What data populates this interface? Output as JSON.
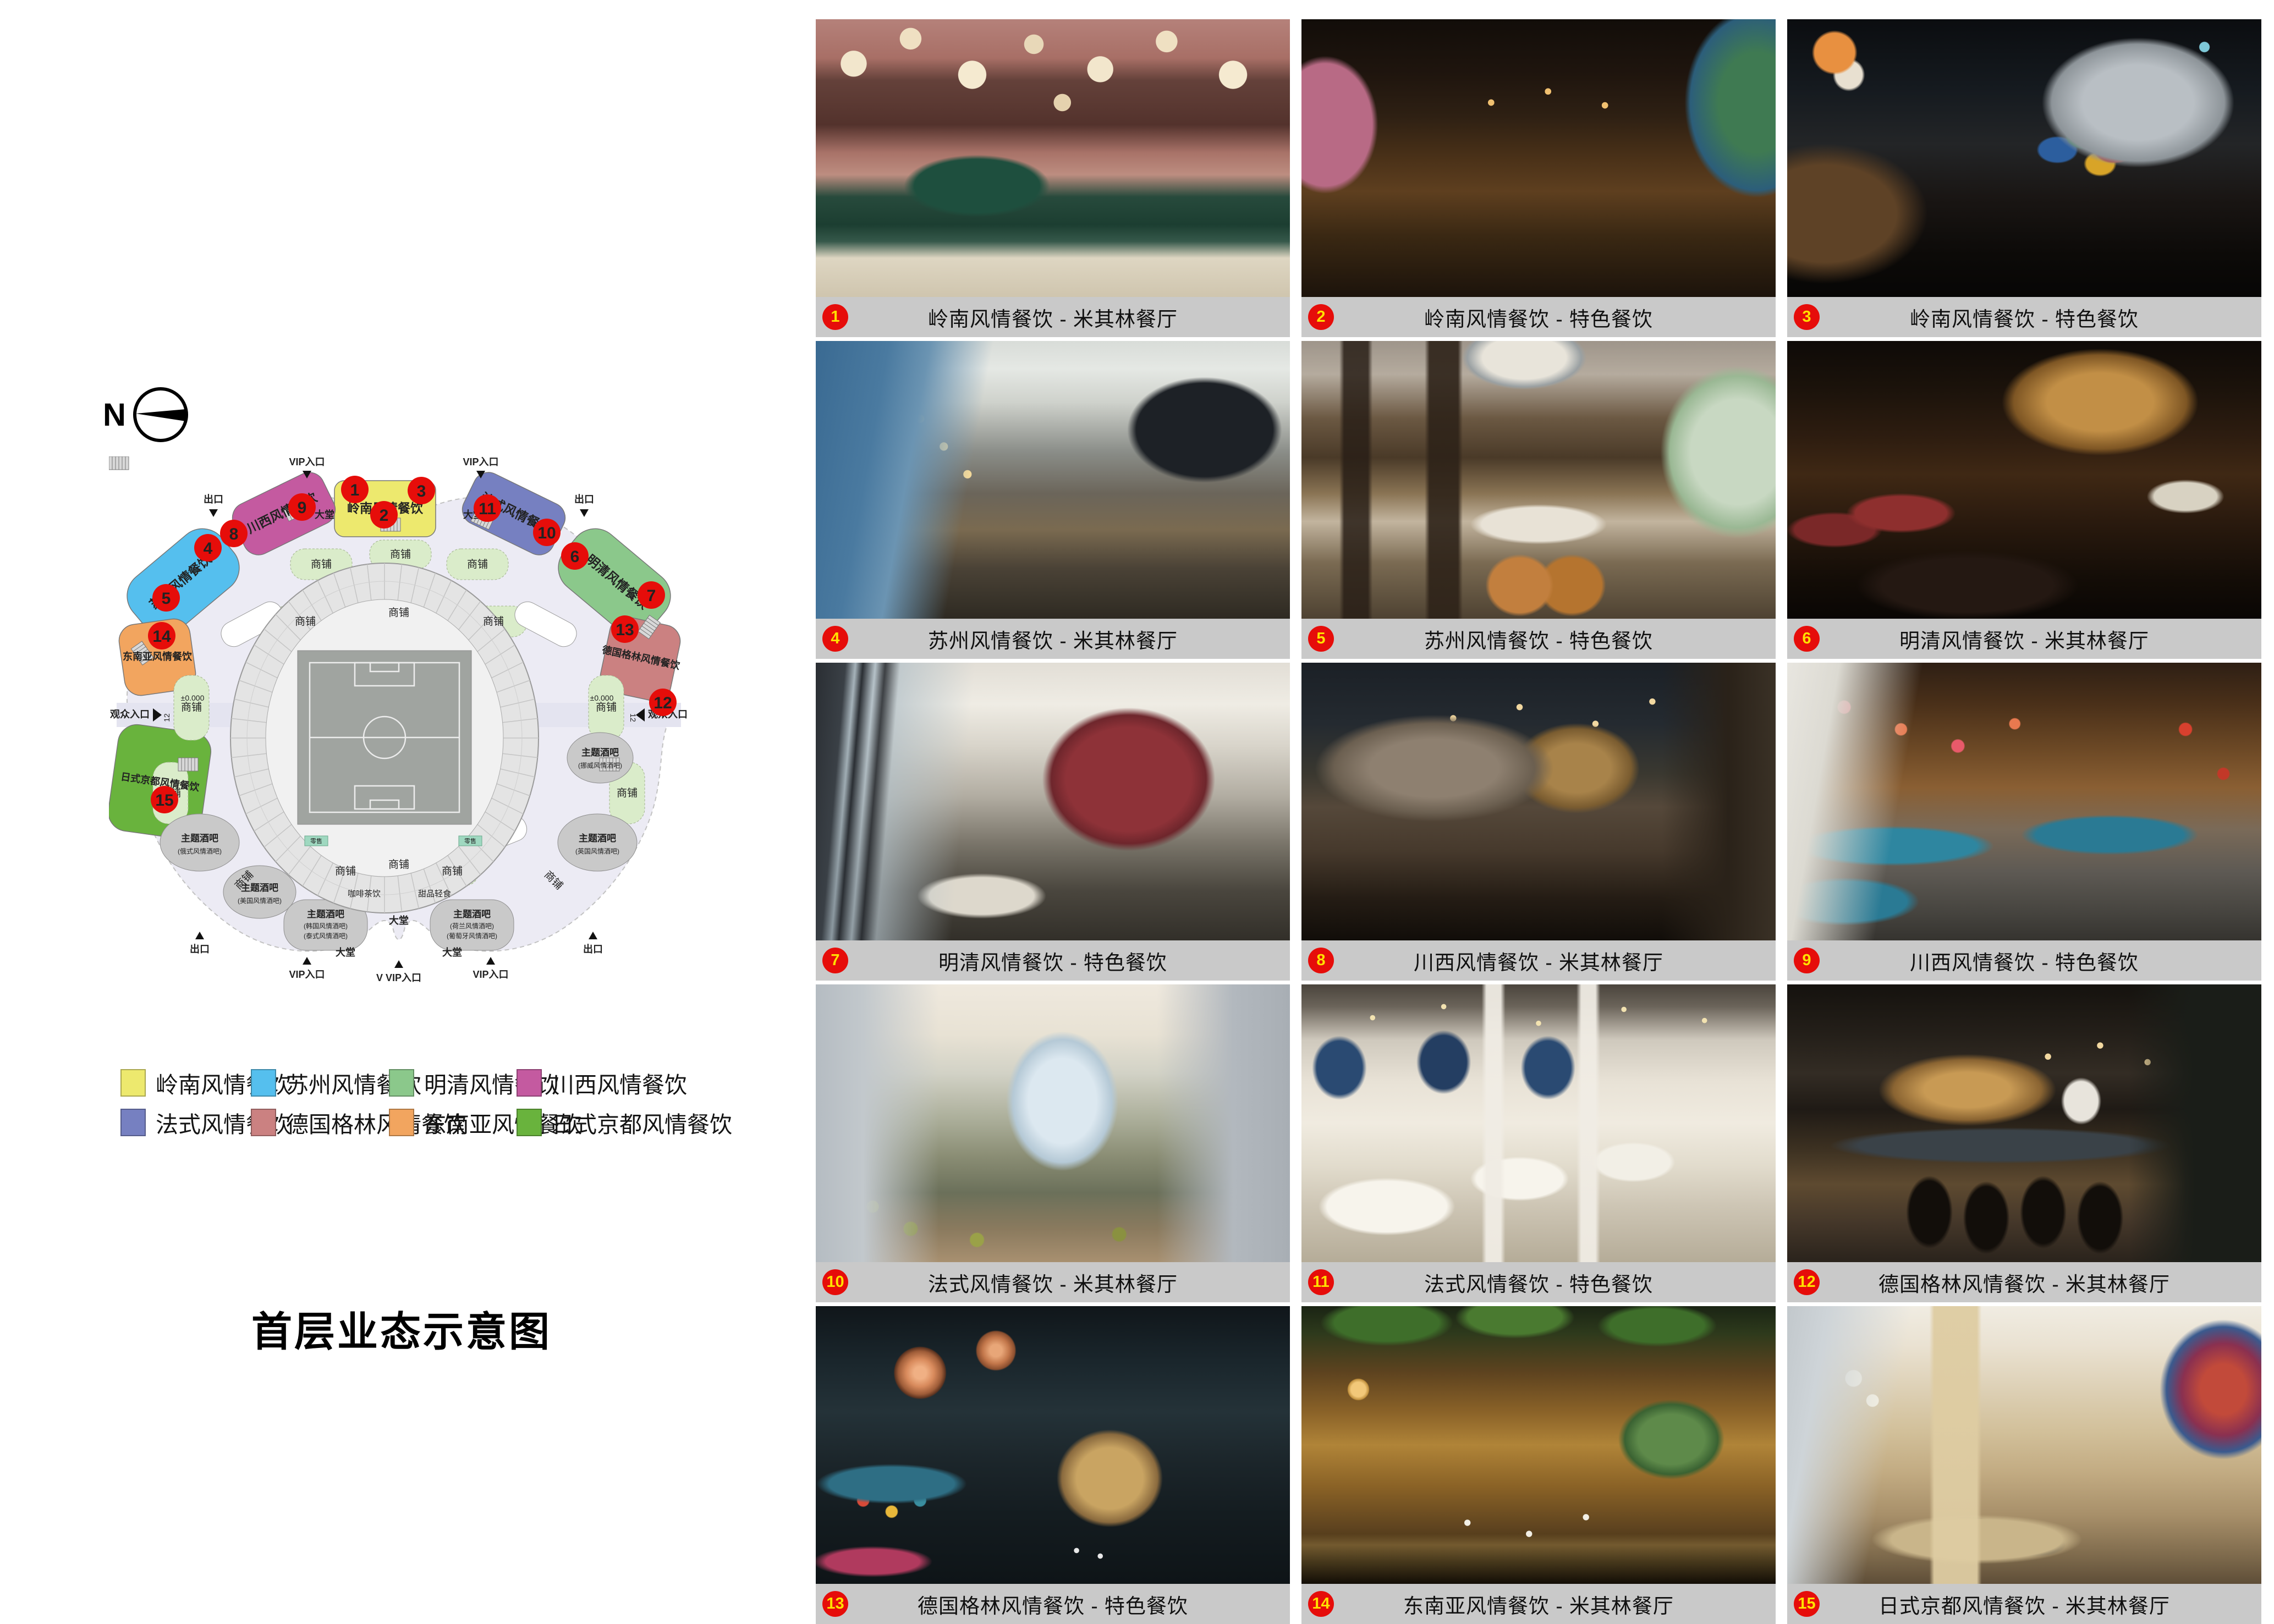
{
  "page": {
    "title": "首层业态示意图"
  },
  "compass": {
    "label": "N"
  },
  "map": {
    "zones": [
      {
        "name": "岭南风情餐饮",
        "color": "#ede96e",
        "markers": [
          "1",
          "2",
          "3"
        ]
      },
      {
        "name": "川西风情餐饮",
        "color": "#c45aa0",
        "markers": [
          "8",
          "9"
        ]
      },
      {
        "name": "法式风情餐饮",
        "color": "#7680c1",
        "markers": [
          "10",
          "11"
        ]
      },
      {
        "name": "苏州风情餐饮",
        "color": "#55bfee",
        "markers": [
          "4",
          "5"
        ]
      },
      {
        "name": "明清风情餐饮",
        "color": "#8bc88b",
        "markers": [
          "6",
          "7"
        ]
      },
      {
        "name": "东南亚风情餐饮",
        "color": "#f2a55f",
        "markers": [
          "14"
        ]
      },
      {
        "name": "德国格林风情餐饮",
        "color": "#cb8181",
        "markers": [
          "12",
          "13"
        ]
      },
      {
        "name": "日式京都风情餐饮",
        "color": "#69b33d",
        "markers": [
          "15"
        ]
      }
    ],
    "markers": [
      "1",
      "2",
      "3",
      "4",
      "5",
      "6",
      "7",
      "8",
      "9",
      "10",
      "11",
      "12",
      "13",
      "14",
      "15"
    ],
    "labels": {
      "vip_entrance": "VIP入口",
      "vvip_entrance": "V VIP入口",
      "exit": "出口",
      "audience_entrance": "观众入口",
      "lobby": "大堂",
      "shop": "商铺",
      "retail": "零售",
      "theme_bar": "主题酒吧",
      "coffee_tea": "咖啡茶饮",
      "dessert": "甜品轻食",
      "elevation": "±0.000",
      "corridor_width": "12",
      "bar_russian": "(俄式风情酒吧)",
      "bar_american": "(美国风情酒吧)",
      "bar_korean": "(韩国风情酒吧)",
      "bar_thai": "(泰式风情酒吧)",
      "bar_dutch": "(荷兰风情酒吧)",
      "bar_portuguese": "(葡萄牙风情酒吧)",
      "bar_british": "(英国风情酒吧)",
      "bar_norwegian": "(挪威风情酒吧)"
    }
  },
  "legend": {
    "items": [
      {
        "label": "岭南风情餐饮",
        "color": "#ede96e"
      },
      {
        "label": "苏州风情餐饮",
        "color": "#55bfee"
      },
      {
        "label": "明清风情餐饮",
        "color": "#8bc88b"
      },
      {
        "label": "川西风情餐饮",
        "color": "#c45aa0"
      },
      {
        "label": "法式风情餐饮",
        "color": "#7680c1"
      },
      {
        "label": "德国格林风情餐饮",
        "color": "#cb8181"
      },
      {
        "label": "东南亚风情餐饮",
        "color": "#f2a55f"
      },
      {
        "label": "日式京都风情餐饮",
        "color": "#69b33d"
      }
    ]
  },
  "gallery": {
    "items": [
      {
        "num": "1",
        "caption": "岭南风情餐饮 - 米其林餐厅"
      },
      {
        "num": "2",
        "caption": "岭南风情餐饮 - 特色餐饮"
      },
      {
        "num": "3",
        "caption": "岭南风情餐饮 - 特色餐饮"
      },
      {
        "num": "4",
        "caption": "苏州风情餐饮 - 米其林餐厅"
      },
      {
        "num": "5",
        "caption": "苏州风情餐饮 - 特色餐饮"
      },
      {
        "num": "6",
        "caption": "明清风情餐饮 - 米其林餐厅"
      },
      {
        "num": "7",
        "caption": "明清风情餐饮 - 特色餐饮"
      },
      {
        "num": "8",
        "caption": "川西风情餐饮 - 米其林餐厅"
      },
      {
        "num": "9",
        "caption": "川西风情餐饮 - 特色餐饮"
      },
      {
        "num": "10",
        "caption": "法式风情餐饮 - 米其林餐厅"
      },
      {
        "num": "11",
        "caption": "法式风情餐饮 - 特色餐饮"
      },
      {
        "num": "12",
        "caption": "德国格林风情餐饮 - 米其林餐厅"
      },
      {
        "num": "13",
        "caption": "德国格林风情餐饮 - 特色餐饮"
      },
      {
        "num": "14",
        "caption": "东南亚风情餐饮 - 米其林餐厅"
      },
      {
        "num": "15",
        "caption": "日式京都风情餐饮 - 米其林餐厅"
      }
    ]
  }
}
